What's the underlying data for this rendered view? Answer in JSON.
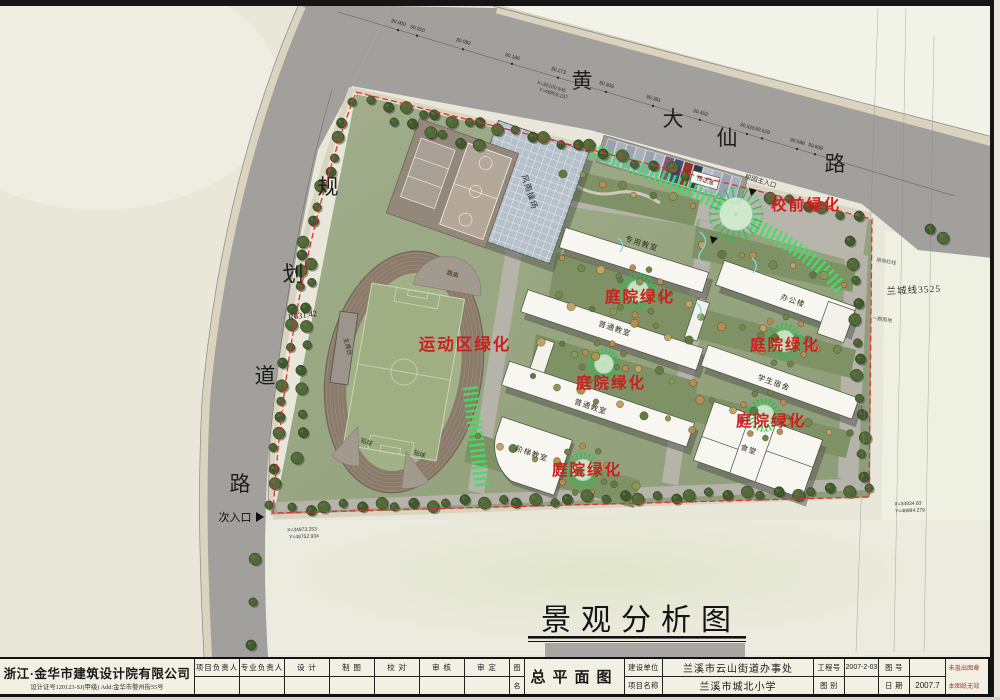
{
  "sheet": {
    "drawing_title": "景观分析图"
  },
  "labels": {
    "sports_green": "运动区绿化",
    "courtyard_green": "庭院绿化",
    "front_green": "校前绿化"
  },
  "roads": {
    "top_road": [
      "黄",
      "大",
      "仙",
      "路"
    ],
    "left_road": [
      "规",
      "划",
      "道",
      "路"
    ],
    "radius": "R631.42",
    "secondary_entrance": "次入口",
    "main_entrance": "校园主入口",
    "lancheng_line": "兰城线3525",
    "red_line": "用地红线",
    "phase1": "一期用地"
  },
  "buildings": {
    "gym": "风雨操场",
    "gym_floor": "1F",
    "special_classroom": "专用教室",
    "classroom_a": "普通教室",
    "classroom_b": "普通教室",
    "stepped_classroom": "阶梯教室",
    "office": "办公楼",
    "dorm": "学生宿舍",
    "canteen": "食堂",
    "reception": "传达室",
    "rostrum": "主席台",
    "high_jump": "跳高",
    "shot_put_a": "铅球",
    "shot_put_b": "铅球"
  },
  "elevations": [
    "30.000",
    "30.020",
    "30.092",
    "30.166",
    "30.273",
    "30.309",
    "30.381",
    "30.453",
    "30.525",
    "30.529",
    "30.598",
    "30.609"
  ],
  "coordinates": {
    "top": {
      "x": "X=35100.545",
      "y": "Y=48853.237"
    },
    "right": {
      "x": "X=34934.83",
      "y": "Y=48994.279"
    },
    "bottom": {
      "x": "X=34973.253",
      "y": "Y=48752.934"
    }
  },
  "title_block": {
    "company": "浙江·金华市建筑设计院有限公司",
    "company_sub": "设计证号120123-SJ(甲级)    Add:金华市婺州街55号",
    "roles": [
      "项目负责人",
      "专业负责人",
      "设 计",
      "制 图",
      "校 对",
      "审 核",
      "审 定"
    ],
    "name_label_chars": [
      "图",
      "名"
    ],
    "drawing_name": "总平面图",
    "client_label": "建设单位",
    "client": "兰溪市云山街道办事处",
    "project_label": "项目名称",
    "project": "兰溪市城北小学",
    "project_no_label": "工程号",
    "project_no": "2007-2-03",
    "category_label": "图 别",
    "category": "",
    "sheet_no_label": "图 号",
    "sheet_no": "",
    "date_label": "日 期",
    "date": "2007.7",
    "stamp_note_1": "未盖出图章",
    "stamp_note_2": "本图纸无效"
  },
  "colors": {
    "red_label": "#cd1f1f",
    "red_line": "#e03131",
    "road_gray": "#a1a09c",
    "green_band": "#44dd66",
    "track_brown": "#8b7b6b",
    "field_green": "#a3b188"
  }
}
